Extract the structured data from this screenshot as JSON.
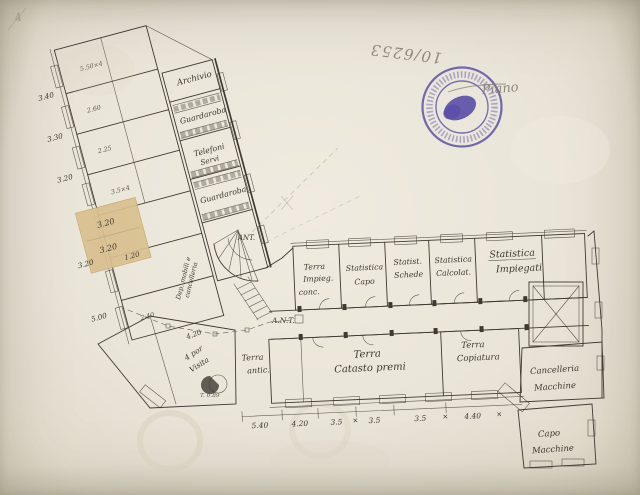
{
  "paper": {
    "background": "#eae5d9",
    "ink": "#3e3a32",
    "pencil": "#8b8578",
    "patch_color": "#d9c08f",
    "stamp_color": "#4a3da0"
  },
  "annotations": {
    "registry_number": "10/6253",
    "pencil_signature": "Piano",
    "corner_mark": "4"
  },
  "stamp": {
    "description": "round violet ink office stamp with illegible circular lettering"
  },
  "left_wing": {
    "room_archivio": "Archivio",
    "room_guardaroba_1": "Guardaroba",
    "room_telefoni_1": "Telefoni",
    "room_telefoni_2": "Servi",
    "room_guardaroba_2": "Guardaroba",
    "room_notes": [
      "5.50×4",
      "2.60",
      "2.25",
      "3.5×4",
      "2.40"
    ],
    "outer_dims": [
      "3.40",
      "3.30",
      "3.20",
      "3.20",
      "5.00"
    ],
    "patch_dims": [
      "3.20",
      "3.20",
      "1.20"
    ],
    "depot_note_1": "Dep. mobili e",
    "depot_note_2": "cancelleria",
    "visita_dim": "4.20",
    "visita_1": "4 por",
    "visita_2": "Visita",
    "scribble": "T. 0.89"
  },
  "center": {
    "ant_upper": "ANT.",
    "ant_lower": "A.N.T."
  },
  "right_wing": {
    "top_rooms": [
      {
        "lines": [
          "Terra",
          "Impieg.",
          "conc."
        ]
      },
      {
        "lines": [
          "Statistica",
          "Capo"
        ]
      },
      {
        "lines": [
          "Statist.",
          "Schede"
        ]
      },
      {
        "lines": [
          "Statistica",
          "Calcolat."
        ]
      },
      {
        "lines": [
          "Statistica",
          "Impiegati"
        ]
      }
    ],
    "bottom_rooms": [
      {
        "lines": [
          "Terra",
          "antic."
        ]
      },
      {
        "lines": [
          "Terra",
          "Catasto premi"
        ]
      },
      {
        "lines": [
          "Terra",
          "Copiatura"
        ]
      }
    ],
    "right_rooms": [
      {
        "lines": [
          "Cancelleria",
          "Macchine"
        ]
      },
      {
        "lines": [
          "Capo",
          "Macchine"
        ]
      }
    ],
    "bottom_dims": [
      "5.40",
      "4.20",
      "3.5",
      "3.5",
      "3.5",
      "4.40"
    ],
    "dim_separator": "×"
  }
}
